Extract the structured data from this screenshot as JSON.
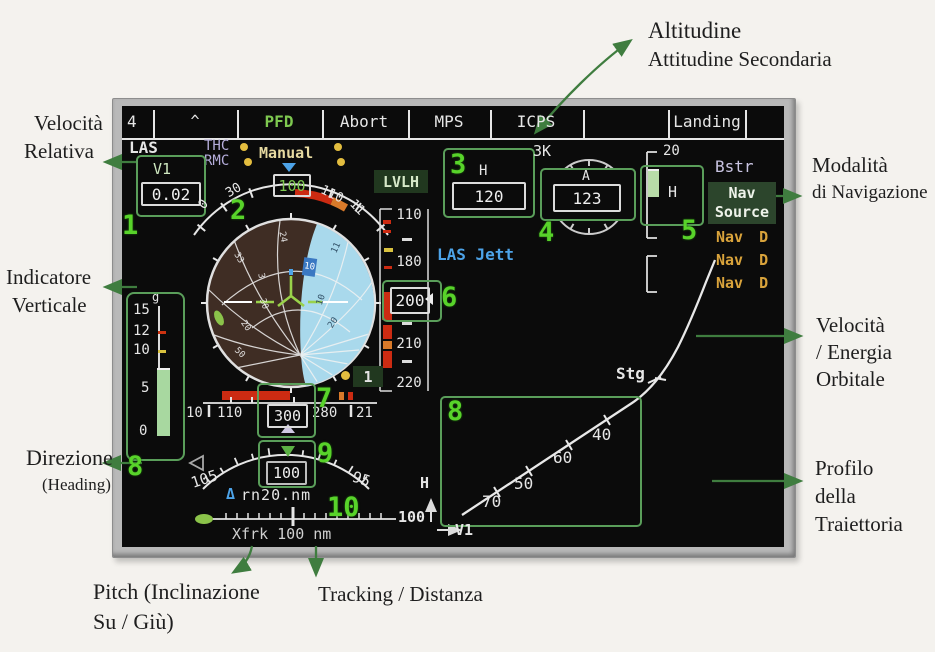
{
  "annotations": {
    "top": {
      "line1": "Altitudine",
      "line2": "Attitudine Secondaria"
    },
    "velocita_relativa": {
      "line1": "Velocità",
      "line2": "Relativa"
    },
    "indicatore": {
      "line1": "Indicatore",
      "line2": "Verticale"
    },
    "direzione": {
      "line1": "Direzione",
      "line2": "(Heading)"
    },
    "modalita": {
      "line1": "Modalità",
      "line2": "di Navigazione"
    },
    "energia": {
      "line1": "Velocità",
      "line2": "/ Energia",
      "line3": "Orbitale"
    },
    "profilo": {
      "line1": "Profilo",
      "line2": "della",
      "line3": "Traiettoria"
    },
    "pitch": {
      "line1": "Pitch (Inclinazione",
      "line2": "Su / Giù)"
    },
    "tracking": {
      "line1": "Tracking / Distanza"
    }
  },
  "callouts": {
    "n1": "1",
    "n2": "2",
    "n3": "3",
    "n4": "4",
    "n5": "5",
    "n6": "6",
    "n7": "7",
    "n8": "8",
    "n8b": "8",
    "n9": "9",
    "n10": "10"
  },
  "menu": {
    "items": [
      "4",
      "^",
      "PFD",
      "Abort",
      "MPS",
      "ICPS",
      "",
      "Landing"
    ]
  },
  "status": {
    "las": "LAS",
    "thc": "THC",
    "rmc": "RMC",
    "manual": "Manual",
    "lvlh": "LVLH",
    "las_jett": "LAS Jett",
    "prefix3k": "3K"
  },
  "v1": {
    "label": "V1",
    "value": "0.02"
  },
  "alt_box": {
    "label": "H",
    "value": "120"
  },
  "att2_box": {
    "label": "A",
    "value": "123"
  },
  "hmeter": {
    "top": "20",
    "label": "H"
  },
  "nav": {
    "bstr": "Bstr",
    "badge_line1": "Nav",
    "badge_line2": "Source",
    "items": [
      "Nav D",
      "Nav D",
      "Nav D"
    ]
  },
  "roll_arc": {
    "l0": "0",
    "l30": "30",
    "value": "100",
    "l110": "110",
    "l11": "11"
  },
  "adi": {
    "left_numbers": [
      "24",
      "3",
      "33",
      "30",
      "20",
      "50"
    ],
    "right_numbers": [
      "11",
      "10",
      "20"
    ],
    "tab": "10",
    "badge": "1"
  },
  "gmeter": {
    "unit": "g",
    "t15": "15",
    "t12": "12",
    "t10": "10",
    "t5": "5",
    "t0": "0"
  },
  "vtape": {
    "l110": "110",
    "l180": "180",
    "value": "200",
    "l210": "210",
    "l220": "220"
  },
  "heading": {
    "l10": "10",
    "l110": "110",
    "value": "300",
    "l280": "280",
    "l21": "21"
  },
  "pitch_scale": {
    "left": "105",
    "value": "100",
    "right": "95"
  },
  "delta": {
    "sym": "Δ",
    "text": "rn20.nm"
  },
  "track": {
    "end": "100",
    "xtrk": "Xfrk 100 nm"
  },
  "graph": {
    "p70": "70",
    "p50": "50",
    "p60": "60",
    "p40": "40",
    "stg": "Stg",
    "yaxis": "H",
    "xaxis": "V1"
  }
}
